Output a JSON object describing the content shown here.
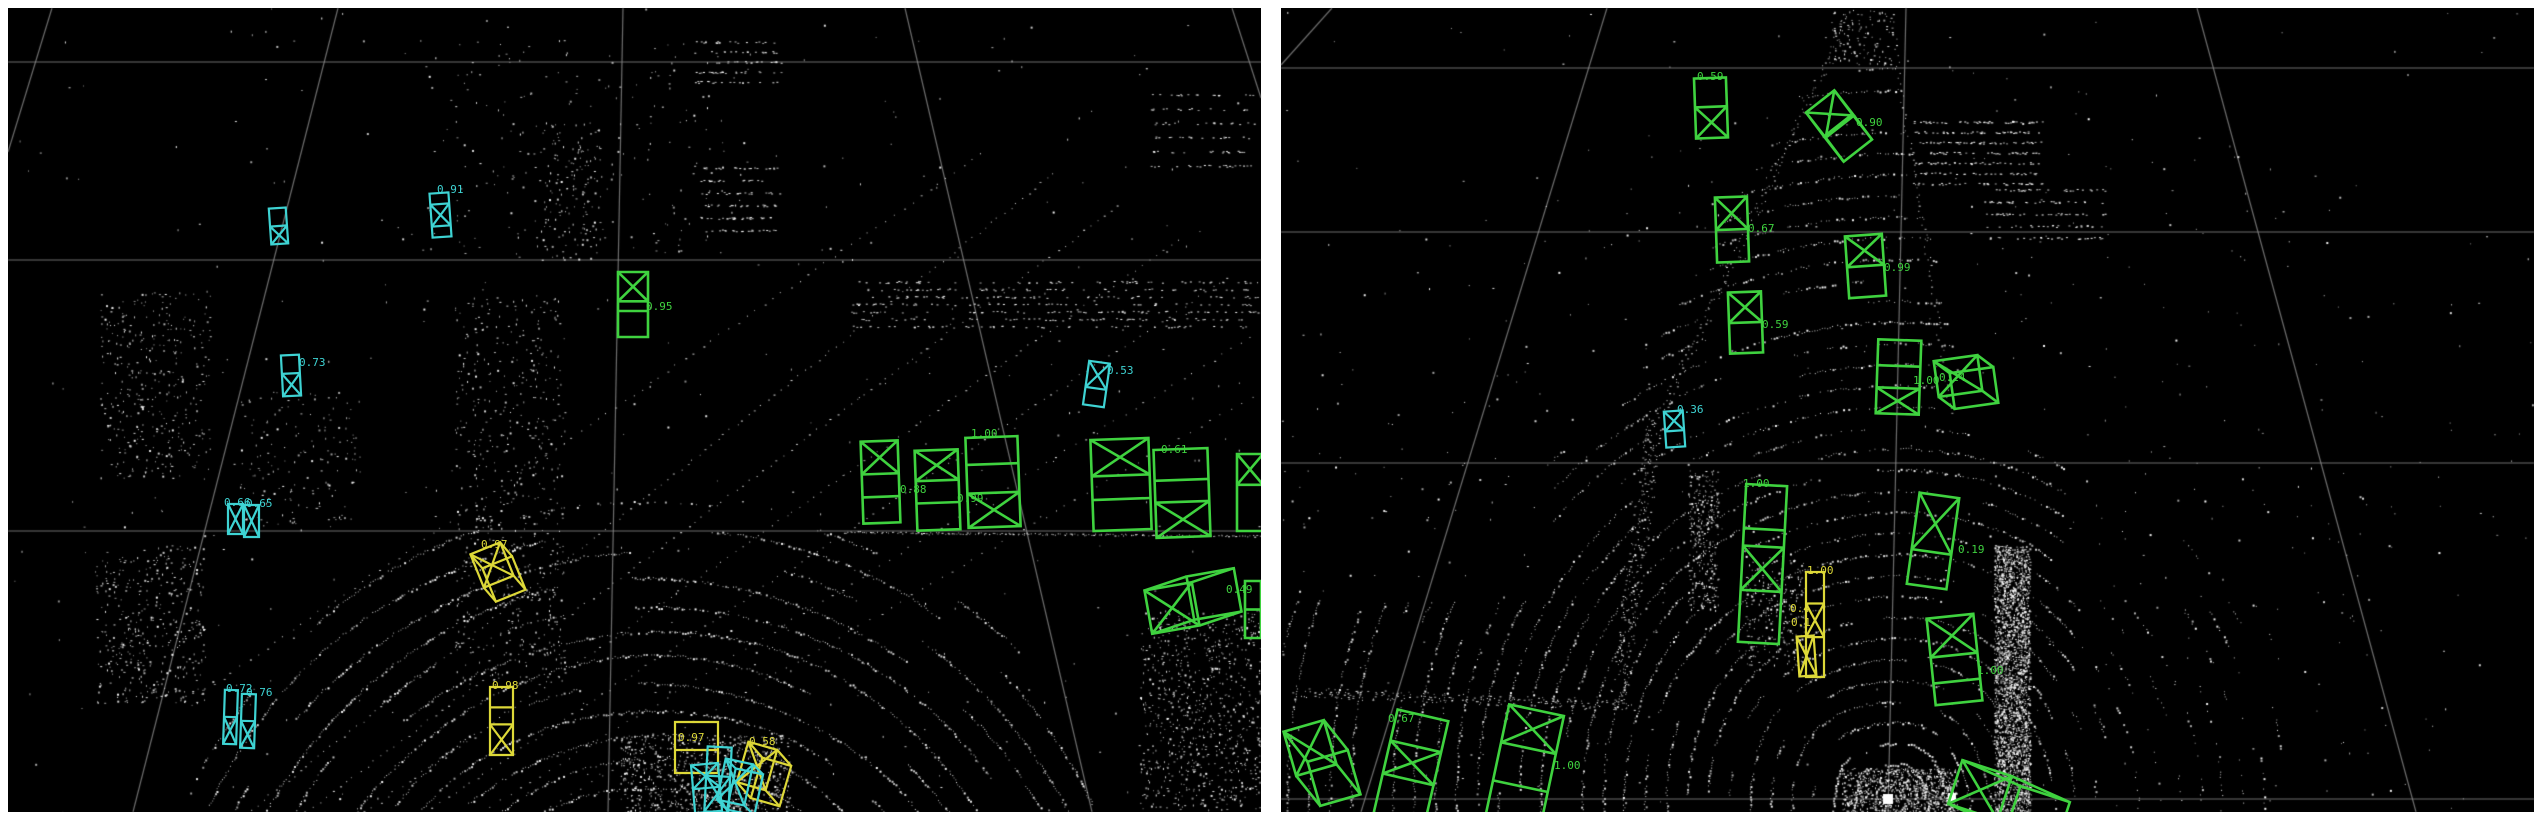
{
  "app": {
    "name": "lidar-3d-detection-viewer",
    "background": "#ffffff",
    "panel_background": "#000000",
    "point_color": "#ffffff",
    "grid_color": "#8a8a8a"
  },
  "class_colors": {
    "green": "#3fd23f",
    "cyan": "#3ed3d3",
    "yellow": "#ddd838"
  },
  "panels": [
    {
      "id": "left",
      "x": 8,
      "y": 8,
      "w": 1253,
      "h": 804
    },
    {
      "id": "right",
      "x": 1281,
      "y": 8,
      "w": 1253,
      "h": 804
    }
  ],
  "grid": {
    "left": [
      [
        8,
        62,
        1261,
        62
      ],
      [
        8,
        260,
        1261,
        260
      ],
      [
        8,
        531,
        1261,
        531
      ],
      [
        623,
        8,
        608,
        812
      ],
      [
        338,
        8,
        133,
        812
      ],
      [
        905,
        8,
        1092,
        812
      ],
      [
        52,
        8,
        8,
        152
      ],
      [
        1232,
        8,
        1261,
        98
      ]
    ],
    "right": [
      [
        1281,
        68,
        2534,
        68
      ],
      [
        1281,
        232,
        2534,
        232
      ],
      [
        1281,
        463,
        2534,
        463
      ],
      [
        1281,
        799,
        2534,
        799
      ],
      [
        1906,
        8,
        1888,
        812
      ],
      [
        1607,
        8,
        1361,
        812
      ],
      [
        2197,
        8,
        2416,
        812
      ],
      [
        1332,
        8,
        1281,
        65
      ],
      [
        1916,
        786,
        1966,
        812
      ]
    ]
  },
  "boxes": [
    {
      "panel": "left",
      "color": "cyan",
      "shape": "flat",
      "x": 270,
      "y": 208,
      "w": 17,
      "h": 36,
      "rot": -4,
      "divs": [
        0.5
      ],
      "xat": 1,
      "label": "",
      "lx": 0,
      "ly": 0
    },
    {
      "panel": "left",
      "color": "cyan",
      "shape": "flat",
      "x": 431,
      "y": 193,
      "w": 19,
      "h": 44,
      "rot": -4,
      "divs": [
        0.25,
        0.75
      ],
      "xat": 1,
      "label": "0.91",
      "lx": 437,
      "ly": 184
    },
    {
      "panel": "left",
      "color": "cyan",
      "shape": "flat",
      "x": 282,
      "y": 355,
      "w": 18,
      "h": 41,
      "rot": -3,
      "divs": [
        0.45
      ],
      "xat": 1,
      "label": "0.73",
      "lx": 299,
      "ly": 357
    },
    {
      "panel": "left",
      "color": "cyan",
      "shape": "flat",
      "x": 228,
      "y": 504,
      "w": 15,
      "h": 30,
      "rot": 0,
      "divs": [],
      "xat": 0,
      "label": "0.66",
      "lx": 224,
      "ly": 497
    },
    {
      "panel": "left",
      "color": "cyan",
      "shape": "flat",
      "x": 244,
      "y": 505,
      "w": 15,
      "h": 32,
      "rot": 0,
      "divs": [],
      "xat": 0,
      "label": "0.65",
      "lx": 246,
      "ly": 498
    },
    {
      "panel": "left",
      "color": "cyan",
      "shape": "flat",
      "x": 224,
      "y": 690,
      "w": 13,
      "h": 54,
      "rot": 2,
      "divs": [
        0.5
      ],
      "xat": 1,
      "label": "0.72",
      "lx": 226,
      "ly": 683
    },
    {
      "panel": "left",
      "color": "cyan",
      "shape": "flat",
      "x": 241,
      "y": 694,
      "w": 14,
      "h": 54,
      "rot": 2,
      "divs": [
        0.5
      ],
      "xat": 1,
      "label": "0.76",
      "lx": 246,
      "ly": 687
    },
    {
      "panel": "left",
      "color": "cyan",
      "shape": "flat",
      "x": 1086,
      "y": 362,
      "w": 21,
      "h": 44,
      "rot": 8,
      "divs": [
        0.6
      ],
      "xat": 0,
      "label": "0.53",
      "lx": 1107,
      "ly": 365
    },
    {
      "panel": "left",
      "color": "green",
      "shape": "flat",
      "x": 618,
      "y": 272,
      "w": 30,
      "h": 65,
      "rot": 0,
      "divs": [
        0.45,
        0.6
      ],
      "xat": 0,
      "label": "0.95",
      "lx": 646,
      "ly": 301
    },
    {
      "panel": "left",
      "color": "green",
      "shape": "flat",
      "x": 862,
      "y": 441,
      "w": 37,
      "h": 82,
      "rot": -2,
      "divs": [
        0.4,
        0.68
      ],
      "xat": 0,
      "label": "",
      "lx": 0,
      "ly": 0
    },
    {
      "panel": "left",
      "color": "green",
      "shape": "flat",
      "x": 916,
      "y": 450,
      "w": 43,
      "h": 80,
      "rot": -2,
      "divs": [
        0.38,
        0.66
      ],
      "xat": 0,
      "label": "0.88",
      "lx": 900,
      "ly": 484
    },
    {
      "panel": "left",
      "color": "green",
      "shape": "flat",
      "x": 967,
      "y": 437,
      "w": 52,
      "h": 90,
      "rot": -2,
      "divs": [
        0.3,
        0.62
      ],
      "xat": 2,
      "label": "1.00",
      "lx": 971,
      "ly": 428
    },
    {
      "panel": "left",
      "color": "green",
      "shape": "flat",
      "x": 1092,
      "y": 439,
      "w": 58,
      "h": 91,
      "rot": -2,
      "divs": [
        0.4,
        0.66
      ],
      "xat": 0,
      "label": "",
      "lx": 0,
      "ly": 0
    },
    {
      "panel": "left",
      "color": "green",
      "shape": "flat",
      "x": 1155,
      "y": 449,
      "w": 54,
      "h": 88,
      "rot": -2,
      "divs": [
        0.35,
        0.6
      ],
      "xat": 2,
      "label": "0.61",
      "lx": 1161,
      "ly": 444
    },
    {
      "panel": "left",
      "color": "green",
      "shape": "flat",
      "x": 1237,
      "y": 454,
      "w": 26,
      "h": 77,
      "rot": 0,
      "divs": [
        0.4
      ],
      "xat": 0,
      "label": "",
      "lx": 0,
      "ly": 0
    },
    {
      "panel": "left",
      "color": "green",
      "shape": "cuboid",
      "cx": 1172,
      "cy": 608,
      "w": 48,
      "h": 44,
      "rot": -10,
      "ex": 42,
      "ey": -14,
      "xat": 0,
      "label": "0.49",
      "lx": 1226,
      "ly": 584
    },
    {
      "panel": "left",
      "color": "green",
      "shape": "flat",
      "x": 1245,
      "y": 581,
      "w": 16,
      "h": 57,
      "rot": 0,
      "divs": [
        0.5
      ],
      "xat": -1,
      "label": "",
      "lx": 0,
      "ly": 0
    },
    {
      "panel": "left",
      "color": "yellow",
      "shape": "cuboid",
      "cx": 492,
      "cy": 565,
      "w": 32,
      "h": 36,
      "rot": -22,
      "ex": 12,
      "ey": 14,
      "xat": 0,
      "label": "0.97",
      "lx": 481,
      "ly": 539
    },
    {
      "panel": "left",
      "color": "yellow",
      "shape": "flat",
      "x": 490,
      "y": 687,
      "w": 23,
      "h": 68,
      "rot": 0,
      "divs": [
        0.3,
        0.55
      ],
      "xat": 2,
      "label": "0.98",
      "lx": 492,
      "ly": 680
    },
    {
      "panel": "left",
      "color": "yellow",
      "shape": "flat",
      "x": 675,
      "y": 722,
      "w": 43,
      "h": 51,
      "rot": 0,
      "divs": [
        0.55
      ],
      "xat": -1,
      "label": "0.97",
      "lx": 678,
      "ly": 732
    },
    {
      "panel": "left",
      "color": "yellow",
      "shape": "cuboid",
      "cx": 757,
      "cy": 766,
      "w": 30,
      "h": 42,
      "rot": 16,
      "ex": 14,
      "ey": 16,
      "xat": 0,
      "label": "0.58",
      "lx": 749,
      "ly": 736
    },
    {
      "panel": "left",
      "color": "cyan",
      "shape": "flat",
      "x": 693,
      "y": 764,
      "w": 27,
      "h": 48,
      "rot": -5,
      "divs": [
        0.5
      ],
      "xat": 0,
      "label": "",
      "lx": 0,
      "ly": 0
    },
    {
      "panel": "left",
      "color": "cyan",
      "shape": "flat",
      "x": 706,
      "y": 747,
      "w": 24,
      "h": 65,
      "rot": 3,
      "divs": [
        0.45
      ],
      "xat": 1,
      "label": "",
      "lx": 0,
      "ly": 0
    },
    {
      "panel": "left",
      "color": "cyan",
      "shape": "cuboid",
      "cx": 735,
      "cy": 782,
      "w": 28,
      "h": 42,
      "rot": 12,
      "ex": 10,
      "ey": 10,
      "xat": 0,
      "label": "",
      "lx": 0,
      "ly": 0
    },
    {
      "panel": "right",
      "color": "green",
      "shape": "flat",
      "x": 1695,
      "y": 78,
      "w": 32,
      "h": 60,
      "rot": -2,
      "divs": [
        0.48
      ],
      "xat": 1,
      "label": "0.59",
      "lx": 1697,
      "ly": 71
    },
    {
      "panel": "right",
      "color": "green",
      "shape": "cuboid",
      "cx": 1830,
      "cy": 114,
      "w": 36,
      "h": 32,
      "rot": -38,
      "ex": 18,
      "ey": 24,
      "xat": 0,
      "label": "0.90",
      "lx": 1856,
      "ly": 117
    },
    {
      "panel": "right",
      "color": "green",
      "shape": "flat",
      "x": 1716,
      "y": 197,
      "w": 32,
      "h": 65,
      "rot": -2,
      "divs": [
        0.5
      ],
      "xat": 0,
      "label": "0.67",
      "lx": 1748,
      "ly": 223
    },
    {
      "panel": "right",
      "color": "green",
      "shape": "flat",
      "x": 1847,
      "y": 235,
      "w": 37,
      "h": 62,
      "rot": -4,
      "divs": [
        0.5
      ],
      "xat": 0,
      "label": "0.99",
      "lx": 1884,
      "ly": 262
    },
    {
      "panel": "right",
      "color": "green",
      "shape": "flat",
      "x": 1729,
      "y": 292,
      "w": 33,
      "h": 61,
      "rot": -2,
      "divs": [
        0.5
      ],
      "xat": 0,
      "label": "0.59",
      "lx": 1762,
      "ly": 319
    },
    {
      "panel": "right",
      "color": "cyan",
      "shape": "flat",
      "x": 1665,
      "y": 411,
      "w": 19,
      "h": 36,
      "rot": -4,
      "divs": [
        0.55
      ],
      "xat": 0,
      "label": "0.36",
      "lx": 1677,
      "ly": 404
    },
    {
      "panel": "right",
      "color": "green",
      "shape": "flat",
      "x": 1742,
      "y": 485,
      "w": 41,
      "h": 158,
      "rot": 3,
      "divs": [
        0.28,
        0.39,
        0.67
      ],
      "xat": 2,
      "label": "1.00",
      "lx": 1743,
      "ly": 478
    },
    {
      "panel": "right",
      "color": "yellow",
      "shape": "flat",
      "x": 1806,
      "y": 572,
      "w": 18,
      "h": 105,
      "rot": 0,
      "divs": [
        0.3,
        0.62
      ],
      "xat": 1,
      "label": "1.00",
      "lx": 1807,
      "ly": 565
    },
    {
      "panel": "right",
      "color": "yellow",
      "shape": "flat",
      "x": 1798,
      "y": 636,
      "w": 17,
      "h": 40,
      "rot": -4,
      "divs": [],
      "xat": 0,
      "label": "",
      "lx": 0,
      "ly": 0
    },
    {
      "panel": "right",
      "color": "green",
      "shape": "flat",
      "x": 1877,
      "y": 340,
      "w": 43,
      "h": 74,
      "rot": 2,
      "divs": [
        0.35,
        0.65
      ],
      "xat": 2,
      "label": "1.00",
      "lx": 1913,
      "ly": 375
    },
    {
      "panel": "right",
      "color": "green",
      "shape": "cuboid",
      "cx": 1958,
      "cy": 376,
      "w": 44,
      "h": 36,
      "rot": -8,
      "ex": 16,
      "ey": 12,
      "xat": 0,
      "label": "0.24",
      "lx": 1939,
      "ly": 372
    },
    {
      "panel": "right",
      "color": "green",
      "shape": "flat",
      "x": 1913,
      "y": 495,
      "w": 40,
      "h": 92,
      "rot": 8,
      "divs": [
        0.62
      ],
      "xat": 0,
      "label": "0.19",
      "lx": 1958,
      "ly": 544
    },
    {
      "panel": "right",
      "color": "green",
      "shape": "flat",
      "x": 1931,
      "y": 616,
      "w": 47,
      "h": 87,
      "rot": -6,
      "divs": [
        0.45,
        0.75
      ],
      "xat": 0,
      "label": "1.00",
      "lx": 1977,
      "ly": 665
    },
    {
      "panel": "right",
      "color": "green",
      "shape": "cuboid",
      "cx": 1980,
      "cy": 790,
      "w": 52,
      "h": 46,
      "rot": 18,
      "ex": 58,
      "ey": 26,
      "xat": 0,
      "label": "",
      "lx": 0,
      "ly": 0
    },
    {
      "panel": "right",
      "color": "green",
      "shape": "cuboid",
      "cx": 1310,
      "cy": 748,
      "w": 42,
      "h": 46,
      "rot": -16,
      "ex": 24,
      "ey": 30,
      "xat": 0,
      "label": "",
      "lx": 0,
      "ly": 0
    },
    {
      "panel": "right",
      "color": "green",
      "shape": "flat",
      "x": 1385,
      "y": 714,
      "w": 52,
      "h": 106,
      "rot": 13,
      "divs": [
        0.3,
        0.62
      ],
      "xat": 1,
      "label": "0.67",
      "lx": 1388,
      "ly": 713
    },
    {
      "panel": "right",
      "color": "green",
      "shape": "flat",
      "x": 1497,
      "y": 709,
      "w": 56,
      "h": 111,
      "rot": 12,
      "divs": [
        0.35,
        0.7
      ],
      "xat": 0,
      "label": "1.00",
      "lx": 1554,
      "ly": 760
    }
  ],
  "floating_labels": [
    {
      "panel": "left",
      "color": "green",
      "text": "0.99",
      "x": 957,
      "y": 493
    },
    {
      "panel": "right",
      "color": "yellow",
      "text": "0.4",
      "x": 1790,
      "y": 603
    },
    {
      "panel": "right",
      "color": "yellow",
      "text": "0.1",
      "x": 1791,
      "y": 617
    }
  ],
  "point_cloud": {
    "left": {
      "seed": 7,
      "arc_center": [
        652,
        1018
      ],
      "arc_r_min": 205,
      "arc_r_max": 540,
      "arc_step": 26,
      "clusters": [
        {
          "t": "rows",
          "x": 848,
          "y": 282,
          "w": 410,
          "h": 52,
          "rows": 7,
          "n": 600
        },
        {
          "t": "rows",
          "x": 694,
          "y": 42,
          "w": 88,
          "h": 50,
          "rows": 5,
          "n": 150
        },
        {
          "t": "rows",
          "x": 700,
          "y": 168,
          "w": 80,
          "h": 75,
          "rows": 6,
          "n": 180
        },
        {
          "t": "rows",
          "x": 1150,
          "y": 95,
          "w": 105,
          "h": 85,
          "rows": 6,
          "n": 160
        },
        {
          "t": "scatter",
          "x": 420,
          "y": 40,
          "w": 330,
          "h": 220,
          "n": 220
        },
        {
          "t": "scatter",
          "x": 100,
          "y": 290,
          "w": 110,
          "h": 190,
          "n": 380
        },
        {
          "t": "scatter",
          "x": 95,
          "y": 545,
          "w": 110,
          "h": 160,
          "n": 420
        },
        {
          "t": "scatter",
          "x": 455,
          "y": 295,
          "w": 110,
          "h": 390,
          "n": 550
        },
        {
          "t": "scatter",
          "x": 1140,
          "y": 610,
          "w": 120,
          "h": 200,
          "n": 800
        },
        {
          "t": "scatter",
          "x": 620,
          "y": 735,
          "w": 170,
          "h": 77,
          "n": 700
        },
        {
          "t": "scatter",
          "x": 540,
          "y": 120,
          "w": 60,
          "h": 140,
          "n": 140
        },
        {
          "t": "scatter",
          "x": 240,
          "y": 390,
          "w": 120,
          "h": 140,
          "n": 160
        },
        {
          "t": "scatter",
          "x": 8,
          "y": 8,
          "w": 1253,
          "h": 804,
          "n": 380
        },
        {
          "t": "dotline",
          "x1": 250,
          "y1": 810,
          "x2": 1060,
          "y2": 168,
          "n": 130,
          "j": 2
        },
        {
          "t": "dotline",
          "x1": 305,
          "y1": 812,
          "x2": 1125,
          "y2": 200,
          "n": 120,
          "j": 2
        },
        {
          "t": "dotline",
          "x1": 365,
          "y1": 812,
          "x2": 1185,
          "y2": 235,
          "n": 115,
          "j": 2
        },
        {
          "t": "dotline",
          "x1": 425,
          "y1": 812,
          "x2": 1235,
          "y2": 272,
          "n": 110,
          "j": 2
        },
        {
          "t": "dotline",
          "x1": 205,
          "y1": 690,
          "x2": 990,
          "y2": 148,
          "n": 90,
          "j": 2
        },
        {
          "t": "dotline",
          "x1": 480,
          "y1": 812,
          "x2": 1261,
          "y2": 330,
          "n": 80,
          "j": 2
        },
        {
          "t": "dotline",
          "x1": 540,
          "y1": 812,
          "x2": 1261,
          "y2": 390,
          "n": 70,
          "j": 2
        },
        {
          "t": "dotline",
          "x1": 845,
          "y1": 532,
          "x2": 1261,
          "y2": 536,
          "n": 180,
          "j": 2
        }
      ]
    },
    "right": {
      "seed": 11,
      "arc_center": [
        1890,
        800
      ],
      "arc_r_min": 16,
      "arc_r_max": 740,
      "arc_step": 21,
      "clusters": [
        {
          "t": "rows",
          "x": 1912,
          "y": 122,
          "w": 130,
          "h": 72,
          "rows": 7,
          "n": 400
        },
        {
          "t": "rows",
          "x": 1985,
          "y": 190,
          "w": 120,
          "h": 60,
          "rows": 5,
          "n": 220
        },
        {
          "t": "scatter",
          "x": 1830,
          "y": 10,
          "w": 65,
          "h": 55,
          "n": 120
        },
        {
          "t": "scatter",
          "x": 1994,
          "y": 545,
          "w": 36,
          "h": 268,
          "n": 2400
        },
        {
          "t": "scatter",
          "x": 1688,
          "y": 470,
          "w": 30,
          "h": 140,
          "n": 300
        },
        {
          "t": "scatter",
          "x": 1745,
          "y": 555,
          "w": 60,
          "h": 110,
          "n": 250
        },
        {
          "t": "scatter",
          "x": 1842,
          "y": 768,
          "w": 115,
          "h": 46,
          "n": 900
        },
        {
          "t": "scatter",
          "x": 1281,
          "y": 8,
          "w": 1253,
          "h": 804,
          "n": 260
        },
        {
          "t": "dotline",
          "x1": 1848,
          "y1": 15,
          "x2": 1658,
          "y2": 420,
          "n": 150,
          "j": 5
        },
        {
          "t": "dotline",
          "x1": 1655,
          "y1": 420,
          "x2": 1618,
          "y2": 700,
          "n": 260,
          "j": 9
        },
        {
          "t": "dotline",
          "x1": 1890,
          "y1": 15,
          "x2": 1952,
          "y2": 420,
          "n": 70,
          "j": 3
        },
        {
          "t": "dotline",
          "x1": 1300,
          "y1": 692,
          "x2": 1630,
          "y2": 706,
          "n": 220,
          "j": 10
        }
      ]
    }
  },
  "markers": [
    {
      "x": 1883,
      "y": 794,
      "w": 10,
      "h": 10
    },
    {
      "x": 1948,
      "y": 793,
      "w": 8,
      "h": 8
    }
  ]
}
